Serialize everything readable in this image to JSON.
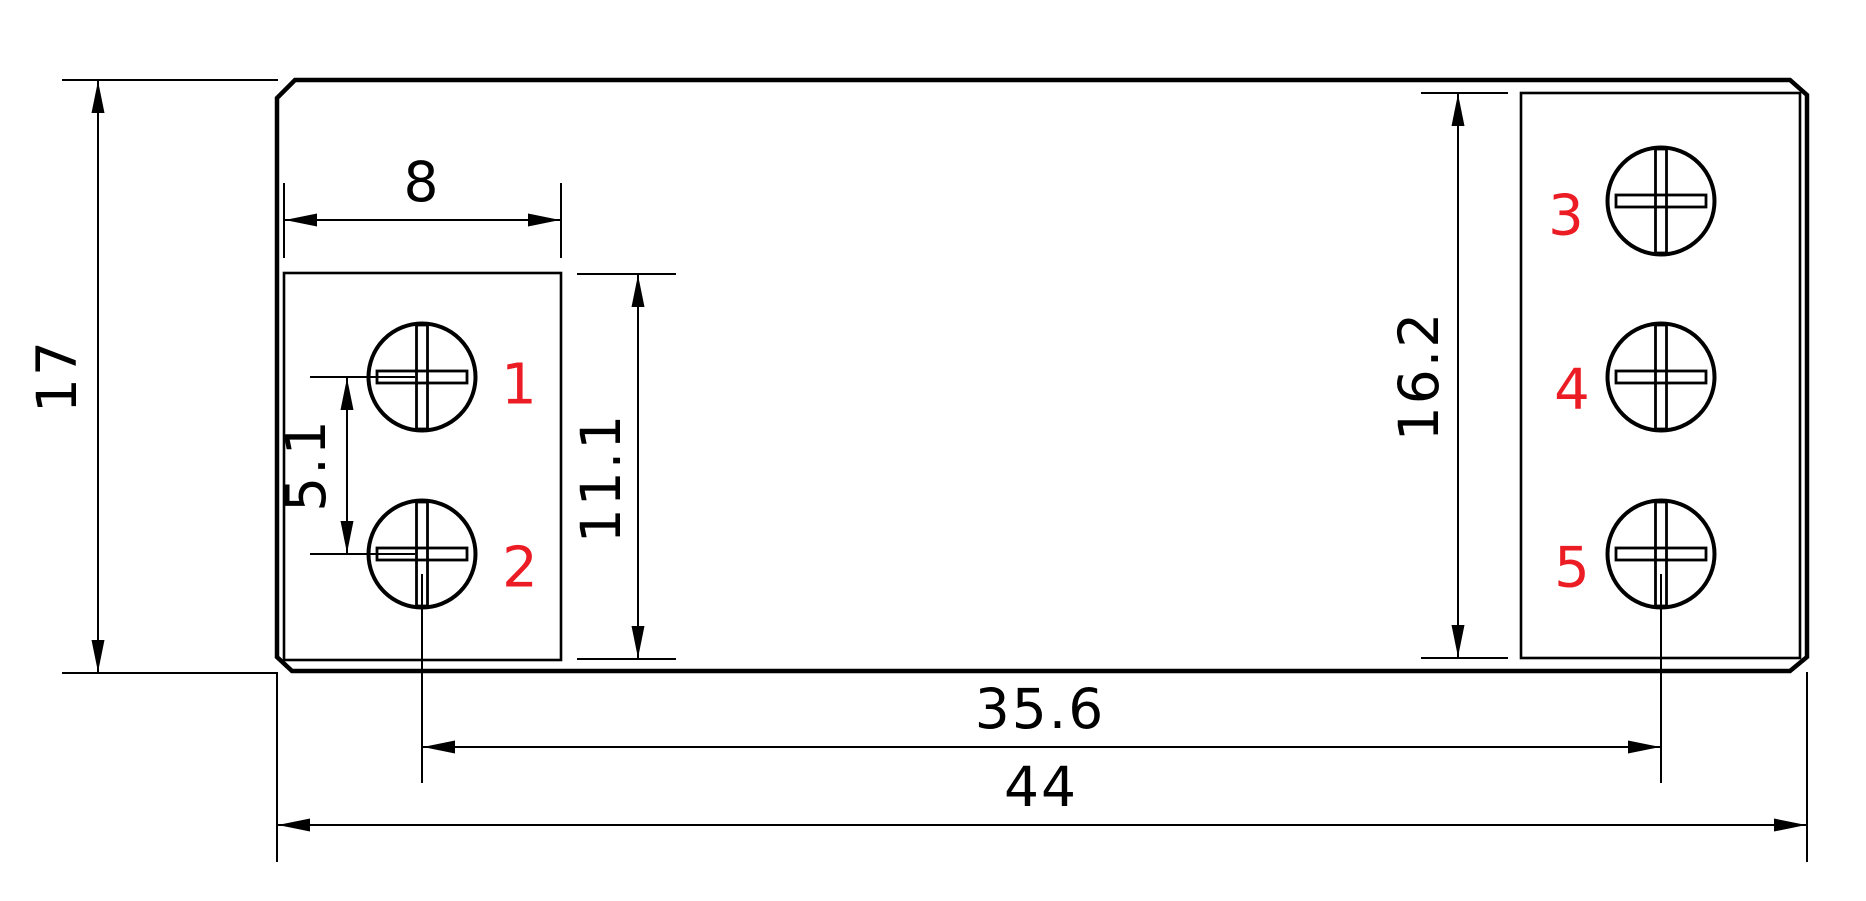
{
  "drawing": {
    "type": "technical-dimension-drawing",
    "background_color": "#ffffff",
    "line_color": "#000000",
    "terminal_label_color": "#ec1c24",
    "dimensions": {
      "overall_height": "17",
      "left_block_width": "8",
      "screw_pitch": "5.1",
      "left_block_height": "11.1",
      "right_block_height": "16.2",
      "screw_center_span": "35.6",
      "overall_width": "44"
    },
    "terminal_labels": {
      "t1": "1",
      "t2": "2",
      "t3": "3",
      "t4": "4",
      "t5": "5"
    }
  }
}
